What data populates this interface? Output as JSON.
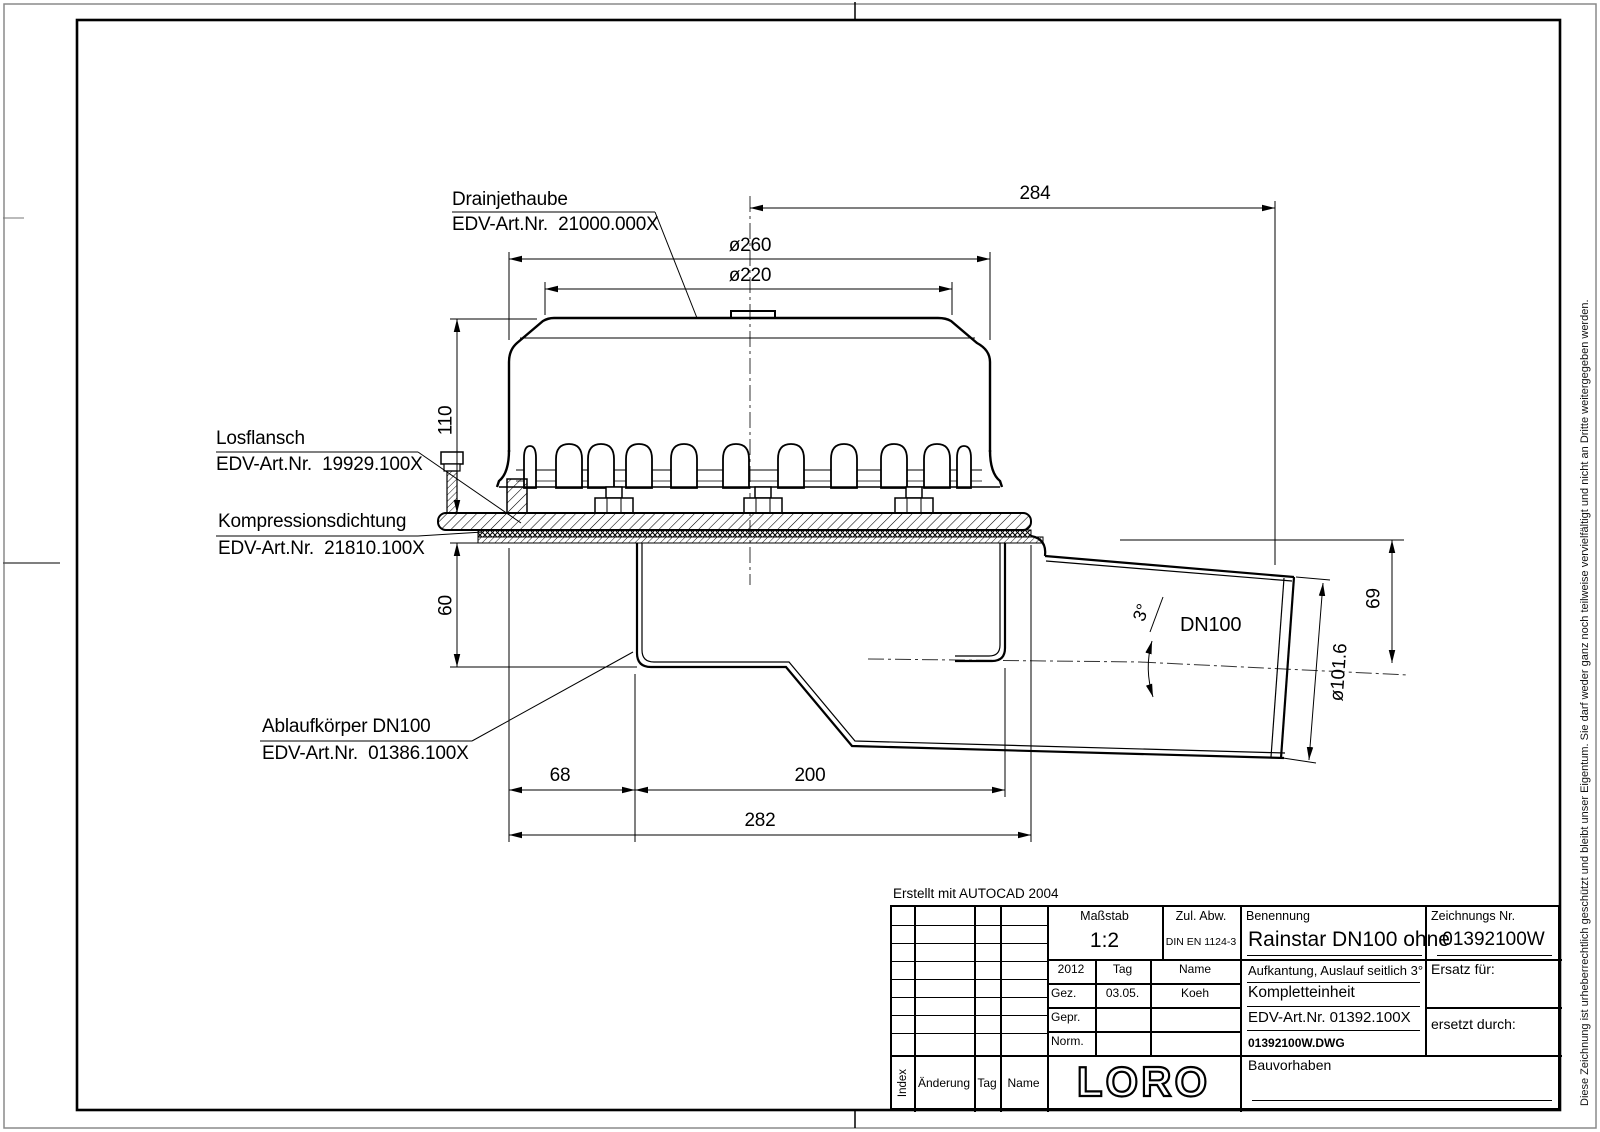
{
  "drawing_labels": {
    "drainjethaube": {
      "name": "Drainjethaube",
      "part_no": "EDV-Art.Nr.  21000.000X"
    },
    "losflansch": {
      "name": "Losflansch",
      "part_no": "EDV-Art.Nr.  19929.100X"
    },
    "kompressionsdichtung": {
      "name": "Kompressionsdichtung",
      "part_no": "EDV-Art.Nr.  21810.100X"
    },
    "ablaufkoerper": {
      "name": "Ablaufkörper DN100",
      "part_no": "EDV-Art.Nr.  01386.100X"
    }
  },
  "dimensions": {
    "d284": "284",
    "d260": "ø260",
    "d220": "ø220",
    "d110": "110",
    "d60": "60",
    "d68": "68",
    "d200": "200",
    "d282": "282",
    "d69": "69",
    "d101": "ø101.6",
    "angle": "3°",
    "pipe": "DN100"
  },
  "notes": {
    "created_with": "Erstellt mit AUTOCAD 2004"
  },
  "copyright": "Diese Zeichnung ist urheberrechtlich geschützt und bleibt unser Eigentum. Sie darf weder ganz noch teilweise vervielfältigt und nicht an Dritte weitergegeben werden.",
  "title_block": {
    "masstab_label": "Maßstab",
    "masstab_value": "1:2",
    "zul_abw_label": "Zul. Abw.",
    "zul_abw_value": "DIN EN 1124-3",
    "benennung_label": "Benennung",
    "benennung_value": "Rainstar DN100 ohne",
    "zeichnungs_nr_label": "Zeichnungs Nr.",
    "zeichnungs_nr_value": "01392100W",
    "rev_year": "2012",
    "rev_tag": "Tag",
    "rev_name": "Name",
    "gez_label": "Gez.",
    "gez_date": "03.05.",
    "gez_name": "Koeh",
    "gepr_label": "Gepr.",
    "norm_label": "Norm.",
    "desc_line1": "Aufkantung, Auslauf seitlich 3°",
    "desc_line2": "Kompletteinheit",
    "desc_line3": "EDV-Art.Nr. 01392.100X",
    "desc_line4": "01392100W.DWG",
    "ersatz_label": "Ersatz für:",
    "ersetzt_label": "ersetzt durch:",
    "logo": "LORO",
    "bauvorhaben_label": "Bauvorhaben",
    "index_label": "Index",
    "aenderung_label": "Änderung",
    "tag_label": "Tag",
    "name_label": "Name"
  }
}
